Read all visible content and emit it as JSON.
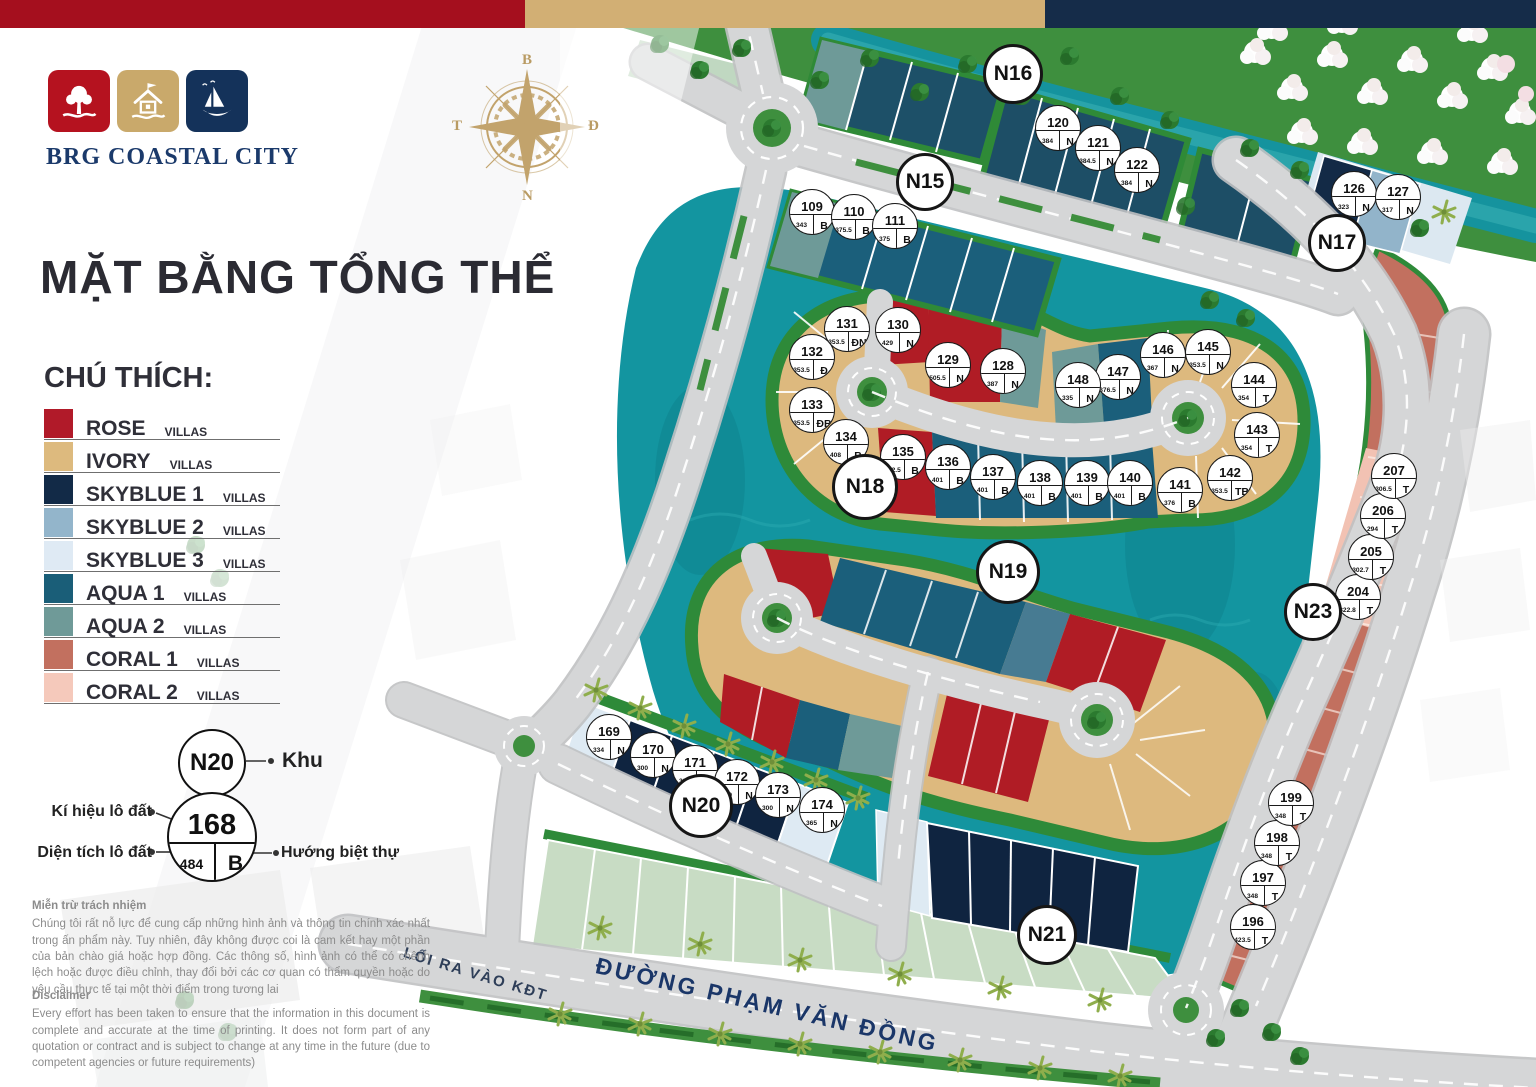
{
  "header_bar": {
    "colors": [
      "#A50F1E",
      "#D2AF74",
      "#152C49"
    ]
  },
  "brand": {
    "name": "BRG COASTAL CITY",
    "tiles": [
      {
        "icon": "tree-icon",
        "color": "#B5121F"
      },
      {
        "icon": "house-icon",
        "color": "#C9A96B"
      },
      {
        "icon": "sailboat-icon",
        "color": "#14325A"
      }
    ]
  },
  "compass": {
    "north": "B",
    "east": "Đ",
    "south": "N",
    "west": "T"
  },
  "title": "MẶT BẰNG TỔNG THỂ",
  "legend": {
    "heading": "CHÚ THÍCH:",
    "items": [
      {
        "name": "ROSE",
        "suffix": "VILLAS",
        "color": "#B11A29"
      },
      {
        "name": "IVORY",
        "suffix": "VILLAS",
        "color": "#DDBA7E"
      },
      {
        "name": "SKYBLUE 1",
        "suffix": "VILLAS",
        "color": "#122A47"
      },
      {
        "name": "SKYBLUE 2",
        "suffix": "VILLAS",
        "color": "#93B5CB"
      },
      {
        "name": "SKYBLUE 3",
        "suffix": "VILLAS",
        "color": "#DFEAF4"
      },
      {
        "name": "AQUA 1",
        "suffix": "VILLAS",
        "color": "#1A5E78"
      },
      {
        "name": "AQUA 2",
        "suffix": "VILLAS",
        "color": "#6F9A98"
      },
      {
        "name": "CORAL 1",
        "suffix": "VILLAS",
        "color": "#C2705F"
      },
      {
        "name": "CORAL 2",
        "suffix": "VILLAS",
        "color": "#F5C9BB"
      }
    ]
  },
  "key": {
    "zone_example": "N20",
    "zone_label": "Khu",
    "lot_example": {
      "number": "168",
      "area": "484",
      "direction": "B"
    },
    "labels": {
      "number": "Kí hiệu lô đất",
      "area": "Diện tích lô đất",
      "direction": "Hướng biệt thự"
    }
  },
  "roads": {
    "main_road": "ĐƯỜNG PHẠM VĂN ĐỒNG",
    "exit_road": "LỐI RA VÀO KĐT"
  },
  "disclaimer_vi": {
    "heading": "Miễn trừ trách nhiệm",
    "body": "Chúng tôi rất nỗ lực để cung cấp những hình ảnh và thông tin chính xác nhất trong ấn phẩm này. Tuy nhiên, đây không được coi là cam kết hay một phần của bản chào giá hoặc hợp đồng. Các thông số, hình ảnh có thể có chênh lệch hoặc được điều chỉnh, thay đổi bởi các cơ quan có thẩm quyền hoặc do yêu cầu thực tế tại một thời điểm trong tương lai"
  },
  "disclaimer_en": {
    "heading": "Disclaimer",
    "body": "Every effort has been taken to ensure that the information in this document is complete and accurate at the time of printing. It does not form part of any quotation or contract and is subject to change at any time in the future (due to competent agencies or future requirements)"
  },
  "map": {
    "zones": [
      {
        "label": "N15",
        "x": 925,
        "y": 182,
        "s": 52
      },
      {
        "label": "N16",
        "x": 1013,
        "y": 74,
        "s": 54
      },
      {
        "label": "N17",
        "x": 1337,
        "y": 243,
        "s": 52
      },
      {
        "label": "N18",
        "x": 865,
        "y": 487,
        "s": 60
      },
      {
        "label": "N19",
        "x": 1008,
        "y": 572,
        "s": 58
      },
      {
        "label": "N20",
        "x": 701,
        "y": 806,
        "s": 58
      },
      {
        "label": "N21",
        "x": 1047,
        "y": 935,
        "s": 54
      },
      {
        "label": "N23",
        "x": 1313,
        "y": 612,
        "s": 52
      }
    ],
    "lots": [
      {
        "number": "109",
        "area": "343",
        "direction": "B",
        "x": 812,
        "y": 212
      },
      {
        "number": "110",
        "area": "375.5",
        "direction": "B",
        "x": 854,
        "y": 217
      },
      {
        "number": "111",
        "area": "375",
        "direction": "B",
        "x": 895,
        "y": 226
      },
      {
        "number": "120",
        "area": "384",
        "direction": "N",
        "x": 1058,
        "y": 128
      },
      {
        "number": "121",
        "area": "384.5",
        "direction": "N",
        "x": 1098,
        "y": 148
      },
      {
        "number": "122",
        "area": "384",
        "direction": "N",
        "x": 1137,
        "y": 170
      },
      {
        "number": "126",
        "area": "323",
        "direction": "N",
        "x": 1354,
        "y": 194
      },
      {
        "number": "127",
        "area": "317",
        "direction": "N",
        "x": 1398,
        "y": 197
      },
      {
        "number": "128",
        "area": "387",
        "direction": "N",
        "x": 1003,
        "y": 371
      },
      {
        "number": "129",
        "area": "505.5",
        "direction": "N",
        "x": 948,
        "y": 365
      },
      {
        "number": "130",
        "area": "429",
        "direction": "N",
        "x": 898,
        "y": 330
      },
      {
        "number": "131",
        "area": "353.5",
        "direction": "ĐN",
        "x": 847,
        "y": 329
      },
      {
        "number": "132",
        "area": "353.5",
        "direction": "Đ",
        "x": 812,
        "y": 357
      },
      {
        "number": "133",
        "area": "353.5",
        "direction": "ĐB",
        "x": 812,
        "y": 410
      },
      {
        "number": "134",
        "area": "408",
        "direction": "B",
        "x": 846,
        "y": 442
      },
      {
        "number": "135",
        "area": "432.5",
        "direction": "B",
        "x": 903,
        "y": 457
      },
      {
        "number": "136",
        "area": "401",
        "direction": "B",
        "x": 948,
        "y": 467
      },
      {
        "number": "137",
        "area": "401",
        "direction": "B",
        "x": 993,
        "y": 477
      },
      {
        "number": "138",
        "area": "401",
        "direction": "B",
        "x": 1040,
        "y": 483
      },
      {
        "number": "139",
        "area": "401",
        "direction": "B",
        "x": 1087,
        "y": 483
      },
      {
        "number": "140",
        "area": "401",
        "direction": "B",
        "x": 1130,
        "y": 483
      },
      {
        "number": "141",
        "area": "376",
        "direction": "B",
        "x": 1180,
        "y": 490
      },
      {
        "number": "142",
        "area": "353.5",
        "direction": "TB",
        "x": 1230,
        "y": 478
      },
      {
        "number": "143",
        "area": "354",
        "direction": "T",
        "x": 1257,
        "y": 435
      },
      {
        "number": "144",
        "area": "354",
        "direction": "T",
        "x": 1254,
        "y": 385
      },
      {
        "number": "145",
        "area": "353.5",
        "direction": "N",
        "x": 1208,
        "y": 352
      },
      {
        "number": "146",
        "area": "367",
        "direction": "N",
        "x": 1163,
        "y": 355
      },
      {
        "number": "147",
        "area": "376.5",
        "direction": "N",
        "x": 1118,
        "y": 377
      },
      {
        "number": "148",
        "area": "335",
        "direction": "N",
        "x": 1078,
        "y": 385
      },
      {
        "number": "169",
        "area": "334",
        "direction": "N",
        "x": 609,
        "y": 737
      },
      {
        "number": "170",
        "area": "300",
        "direction": "N",
        "x": 653,
        "y": 755
      },
      {
        "number": "171",
        "area": "300",
        "direction": "N",
        "x": 695,
        "y": 768
      },
      {
        "number": "172",
        "area": "300",
        "direction": "N",
        "x": 737,
        "y": 782
      },
      {
        "number": "173",
        "area": "300",
        "direction": "N",
        "x": 778,
        "y": 795
      },
      {
        "number": "174",
        "area": "365",
        "direction": "N",
        "x": 822,
        "y": 810
      },
      {
        "number": "196",
        "area": "423.5",
        "direction": "T",
        "x": 1253,
        "y": 927
      },
      {
        "number": "197",
        "area": "348",
        "direction": "T",
        "x": 1263,
        "y": 883
      },
      {
        "number": "198",
        "area": "348",
        "direction": "T",
        "x": 1277,
        "y": 843
      },
      {
        "number": "199",
        "area": "348",
        "direction": "T",
        "x": 1291,
        "y": 803
      },
      {
        "number": "204",
        "area": "322.8",
        "direction": "T",
        "x": 1358,
        "y": 597
      },
      {
        "number": "205",
        "area": "302.7",
        "direction": "T",
        "x": 1371,
        "y": 557
      },
      {
        "number": "206",
        "area": "294",
        "direction": "T",
        "x": 1383,
        "y": 516
      },
      {
        "number": "207",
        "area": "306.5",
        "direction": "T",
        "x": 1394,
        "y": 476
      }
    ]
  }
}
